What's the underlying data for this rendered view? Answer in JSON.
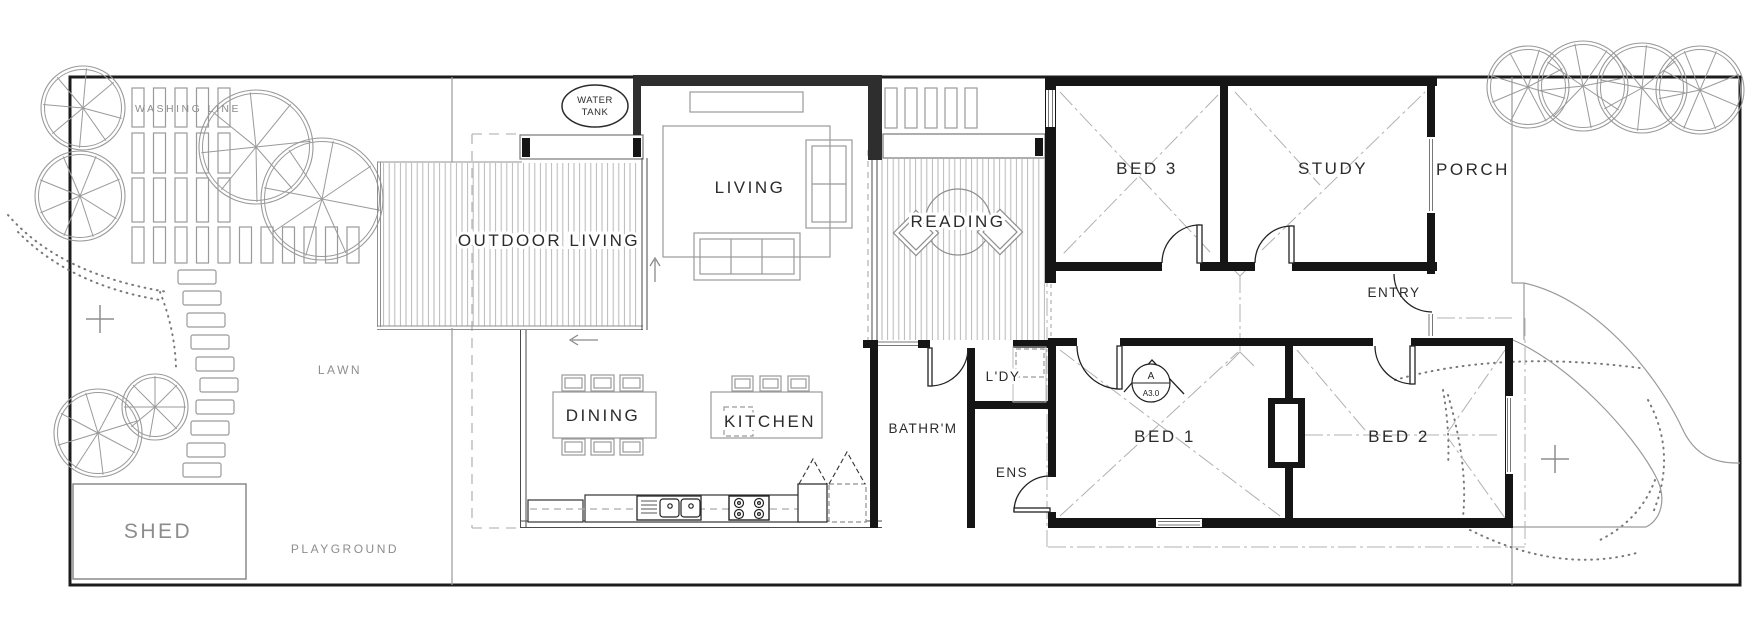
{
  "site": {
    "washing_line": "WASHING LINE",
    "lawn": "LAWN",
    "shed": "SHED",
    "playground": "PLAYGROUND",
    "water_tank": {
      "line1": "WATER",
      "line2": "TANK"
    }
  },
  "rooms": {
    "outdoor_living": "OUTDOOR LIVING",
    "living": "LIVING",
    "reading": "READING",
    "dining": "DINING",
    "kitchen": "KITCHEN",
    "bed3": "BED 3",
    "study": "STUDY",
    "porch": "PORCH",
    "entry": "ENTRY",
    "laundry": "L'DY",
    "bathroom": "BATHR'M",
    "ensuite": "ENS",
    "bed1": "BED 1",
    "bed2": "BED 2"
  },
  "markers": {
    "section_label": "A",
    "section_sheet": "A3.0"
  },
  "colors": {
    "existing_wall": "#151515",
    "new_wall": "#2e2e2e",
    "furniture_line": "#999999",
    "deck_hatch": "#b8b8b8",
    "site_text": "#8d8d8d",
    "room_text": "#2b2b2b"
  }
}
